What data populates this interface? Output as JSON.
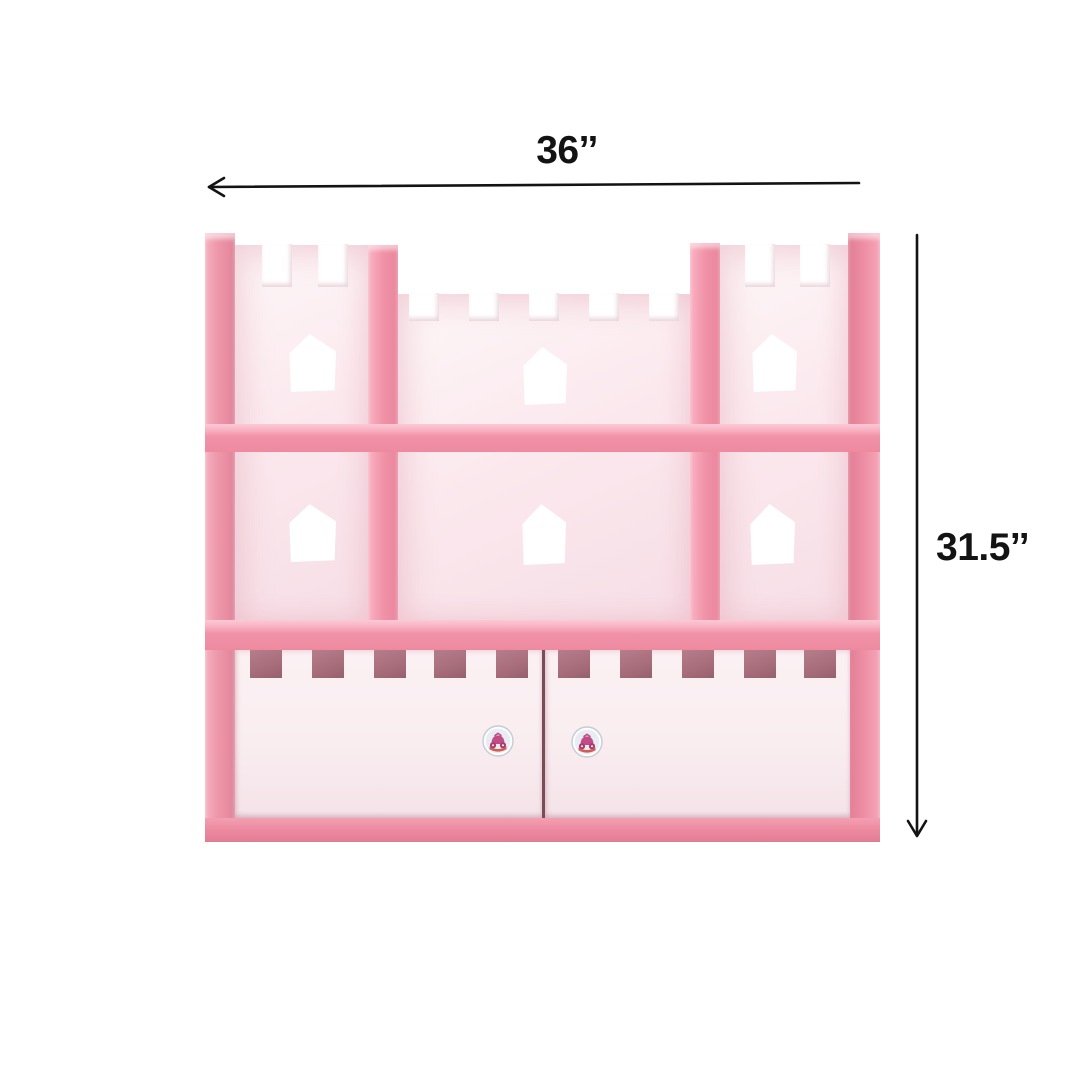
{
  "scene": {
    "type": "product dimension diagram",
    "background": "#ffffff",
    "dimensions": {
      "width_label": "36’’",
      "height_label": "31.5’’"
    },
    "product": {
      "description": "Pink castle-shaped kids wall shelf: two crenellated towers, six house-shaped window cutouts, two open shelf rows, and two lower drawers with castellated top edges and princess-carriage knobs",
      "tower_count": 2,
      "window_cutout_count": 6,
      "drawer_count": 2,
      "knob_count": 2,
      "knob_style": "princess-carriage"
    },
    "colors": {
      "background": "#ffffff",
      "frame_pink": "#f192a8",
      "frame_pink_light": "#f8b3c3",
      "frame_pink_dark": "#e5839a",
      "panel_light": "#fbe9ee",
      "drawer_front": "#f9edf0",
      "notch_interior": "#a96e7c",
      "drawer_gap": "#7a4c57",
      "base_pink": "#ec879e",
      "dimension_ink": "#131313",
      "knob_ring": "#c4ccd6",
      "knob_face": "#e7edf3",
      "knob_carriage": "#c14c86",
      "knob_base_red": "#d25b52"
    }
  }
}
